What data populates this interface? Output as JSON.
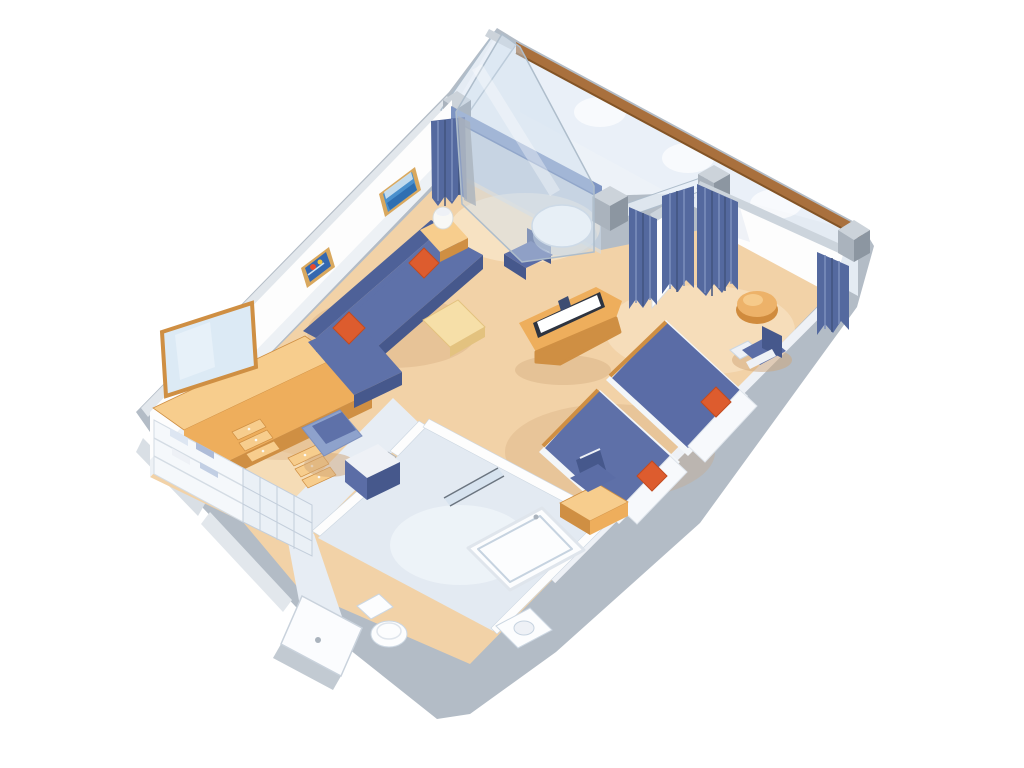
{
  "scene": {
    "type": "isometric-floor-plan",
    "subject": "cruise-ship-suite-with-private-balcony",
    "rooms": [
      {
        "name": "living-room",
        "items": [
          "l-shaped-sofa",
          "orange-accent-pillows",
          "coffee-table",
          "side-table-with-lamp",
          "round-table",
          "dining-chair",
          "tv-cabinet",
          "flat-tv",
          "wall-art-seascape",
          "wall-art-fish",
          "vanity-dresser-with-mirror",
          "vanity-stool",
          "minibar-cabinet",
          "closet-shelves",
          "storage-baskets"
        ]
      },
      {
        "name": "balcony",
        "items": [
          "glass-balustrade",
          "wood-handrail",
          "privacy-divider-panel",
          "deck",
          "corner-posts"
        ]
      },
      {
        "name": "bedroom",
        "items": [
          "twin-bed-1",
          "twin-bed-2",
          "white-pillows",
          "orange-cushions",
          "desk",
          "desk-chair",
          "armchair",
          "armchair-side-table",
          "round-ottoman",
          "divider-curtains"
        ]
      },
      {
        "name": "bathroom",
        "items": [
          "bathtub",
          "shower-glass",
          "toilet",
          "sink"
        ]
      },
      {
        "name": "entry",
        "items": [
          "entry-door",
          "corridor"
        ]
      }
    ]
  },
  "colors": {
    "bg": "#ffffff",
    "wall_gray": "#b3bcc6",
    "wall_gray_light": "#d9dfe5",
    "wall_outer_band": "#e2e7ec",
    "wall_white": "#fdfdfd",
    "wall_shade": "#edf1f5",
    "wall_shade2": "#e8edf3",
    "wall_cap": "#ccd4dc",
    "wall_blue_cap": "#7e95c3",
    "wall_blue_cap_edge": "#5f79ad",
    "glass": "#e9f0f7",
    "glass_tint": "#cfdded",
    "glass_edge": "#aebdcb",
    "deck": "#edf2f8",
    "scallop": "#ffffff",
    "rail_wood": "#a9703d",
    "rail_wood_dark": "#835426",
    "post_light": "#ccd3da",
    "post_mid": "#aab3bd",
    "post_dark": "#8c96a1",
    "curtain": "#54699f",
    "curtain_dark": "#41547f",
    "curtain_light": "#7d90bd",
    "carpet": "#f2d2a7",
    "carpet_light": "#fae8cd",
    "carpet_cream": "#f7e3c2",
    "carpet_shadow": "#cfa577",
    "bath_floor": "#e3eaf2",
    "bath_light": "#f4f8fc",
    "corridor_floor": "#e7edf4",
    "sofa": "#5e71a9",
    "sofa_dark": "#46588c",
    "sofa_top": "#4e6198",
    "chair_blue": "#5b6da6",
    "chair_light": "#8ea2cc",
    "orange": "#dd5c2e",
    "orange_dark": "#c24b20",
    "bed_spread": "#5e70a8",
    "bed_spread2": "#5a6ca6",
    "bed_base": "#f3f6f9",
    "pillow_white": "#f7f9fc",
    "pillow_edge": "#dfe5ec",
    "wood": "#eeae5c",
    "wood_light": "#f7cd8d",
    "wood_dark": "#cf8f43",
    "wood_pale": "#f6dfa8",
    "wood_pale_edge": "#e3c27f",
    "tv_frame": "#2e3440",
    "tv_screen": "#ffffff",
    "tv_box": "#3d4d72",
    "mirror": "#dceaf5",
    "mirror_hi": "#eaf3fa",
    "frame_wood": "#d9a85e",
    "art_sea": "#4a90cd",
    "art_sea_dark": "#2f6fb2",
    "art_sky": "#cfe3f2",
    "art_bg": "#3568b0",
    "art_red": "#e84b2c",
    "art_yellow": "#f2c23e",
    "fixture": "#fcfdfe",
    "fixture_edge": "#ccd7e2",
    "fixture_inner": "#c6d3e0",
    "shower_line": "#6b7580",
    "ottoman": "#edb269",
    "ottoman_dark": "#d08b3d",
    "ottoman_hi": "#f7cf92",
    "lamp": "#f8f8f5",
    "lamp_edge": "#d9dbd8",
    "white_soft": "#eef1f6",
    "closet_face": "#f5f8fb",
    "closet_line": "#d4dce4",
    "towel_a": "#dde6f2",
    "towel_b": "#aebcd8",
    "towel_c": "#c2cfe4",
    "basket": "#eaf0f6",
    "basket_line": "#c3cedb",
    "door_white": "#fbfcfe",
    "door_edge": "#c9d2dc",
    "step_gray": "#c2cad2"
  }
}
